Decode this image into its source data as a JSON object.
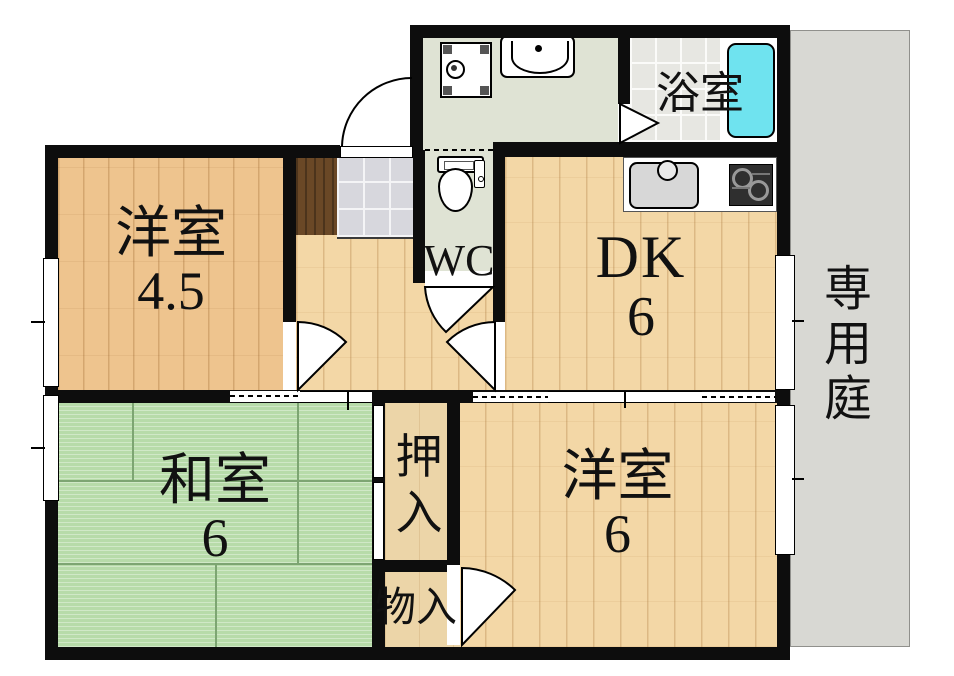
{
  "plan": {
    "title": "2DK apartment floor plan",
    "rooms": {
      "western1": {
        "name": "洋室",
        "size": "4.5"
      },
      "dk": {
        "name": "DK",
        "size": "6"
      },
      "japanese": {
        "name": "和室",
        "size": "6"
      },
      "western2": {
        "name": "洋室",
        "size": "6"
      },
      "wc": {
        "name": "WC"
      },
      "bath": {
        "name": "浴室"
      },
      "garden": {
        "name": "専用庭",
        "chars": [
          "専",
          "用",
          "庭"
        ]
      },
      "oshiire": {
        "name": "押入",
        "chars": [
          "押",
          "入"
        ]
      },
      "monoire": {
        "name": "物入"
      }
    },
    "colors": {
      "wall": "#0d0d0d",
      "wood_warm": "#eec48e",
      "wood_light": "#f3d7a6",
      "tatami_green": "#b7dba9",
      "bathtub_cyan": "#6fe3ef",
      "garden_gray": "#d8d8d3",
      "washroom_sage": "#dfe3d4",
      "cabinet_brown": "#6a4826"
    }
  }
}
